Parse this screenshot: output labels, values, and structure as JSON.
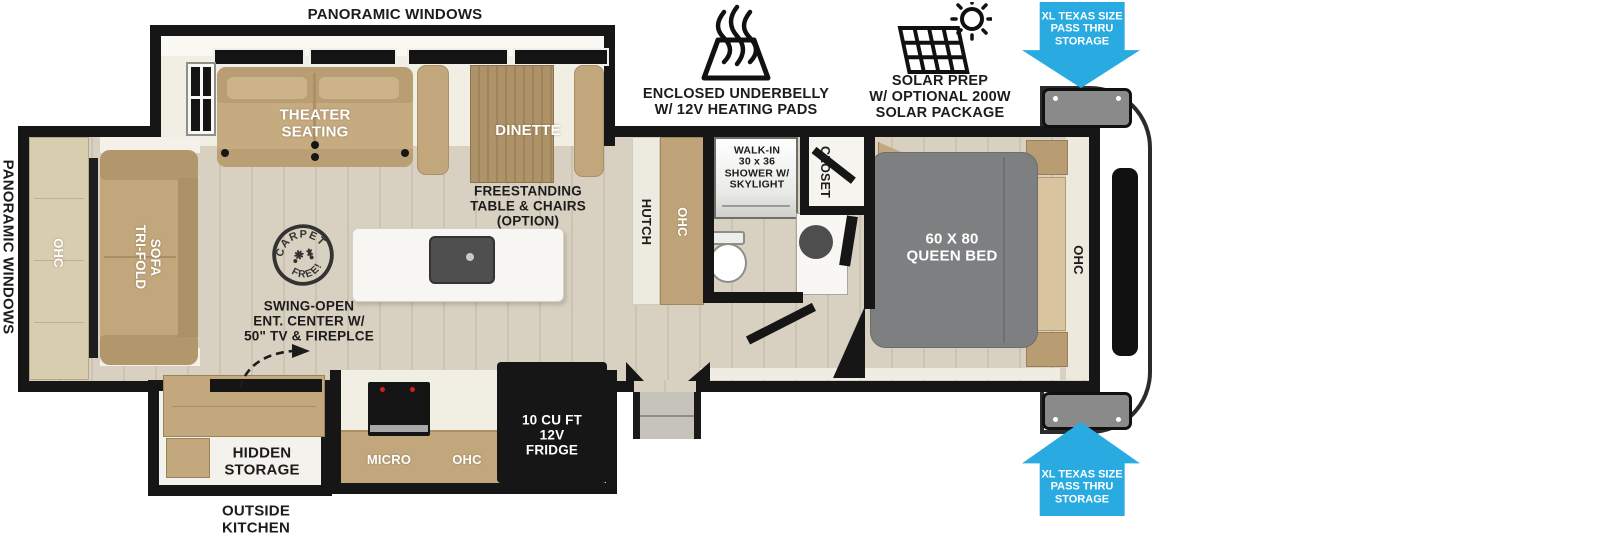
{
  "colors": {
    "arrow_blue": "#29ABE2",
    "wall_black": "#161616",
    "floor_tan": "#D6CEBE",
    "furniture_tan": "#C2A77D",
    "slide_cream": "#F1EEE4",
    "bed_gray": "#7E7F80",
    "appliance_black": "#161616",
    "hatch_gray": "#8A8A8A"
  },
  "callouts": {
    "underbelly_label": "ENCLOSED UNDERBELLY\nW/ 12V HEATING PADS",
    "solar_label": "SOLAR PREP\nW/ OPTIONAL 200W\nSOLAR PACKAGE",
    "pass_thru_front_top": "XL TEXAS SIZE\nPASS THRU\nSTORAGE",
    "pass_thru_front_bottom": "XL TEXAS SIZE\nPASS THRU\nSTORAGE",
    "swing_open_note": "SWING-OPEN\nENT. CENTER W/\n50\" TV & FIREPLCE",
    "carpet_stamp": {
      "top": "CARPET",
      "bottom": "FREE!"
    }
  },
  "exterior_labels": {
    "panoramic_windows_top": "PANORAMIC WINDOWS",
    "panoramic_windows_left": "PANORAMIC WINDOWS",
    "outside_kitchen": "OUTSIDE\nKITCHEN"
  },
  "living_area": {
    "theater_seating": "THEATER\nSEATING",
    "dinette": "DINETTE",
    "freestanding_option": "FREESTANDING\nTABLE & CHAIRS\n(OPTION)",
    "tri_fold_sofa": "TRI-FOLD\nSOFA",
    "ohc_rear": "OHC"
  },
  "kitchen": {
    "hutch": "HUTCH",
    "hutch_ohc": "OHC",
    "micro": "MICRO",
    "kitchen_ohc": "OHC",
    "fridge": "10 CU FT\n12V\nFRIDGE",
    "hidden_storage": "HIDDEN\nSTORAGE"
  },
  "bathroom": {
    "shower": "WALK-IN\n30 x 36\nSHOWER W/\nSKYLIGHT",
    "closet": "CLOSET"
  },
  "bedroom": {
    "queen_bed": "60 X 80\nQUEEN BED",
    "ohc": "OHC"
  }
}
